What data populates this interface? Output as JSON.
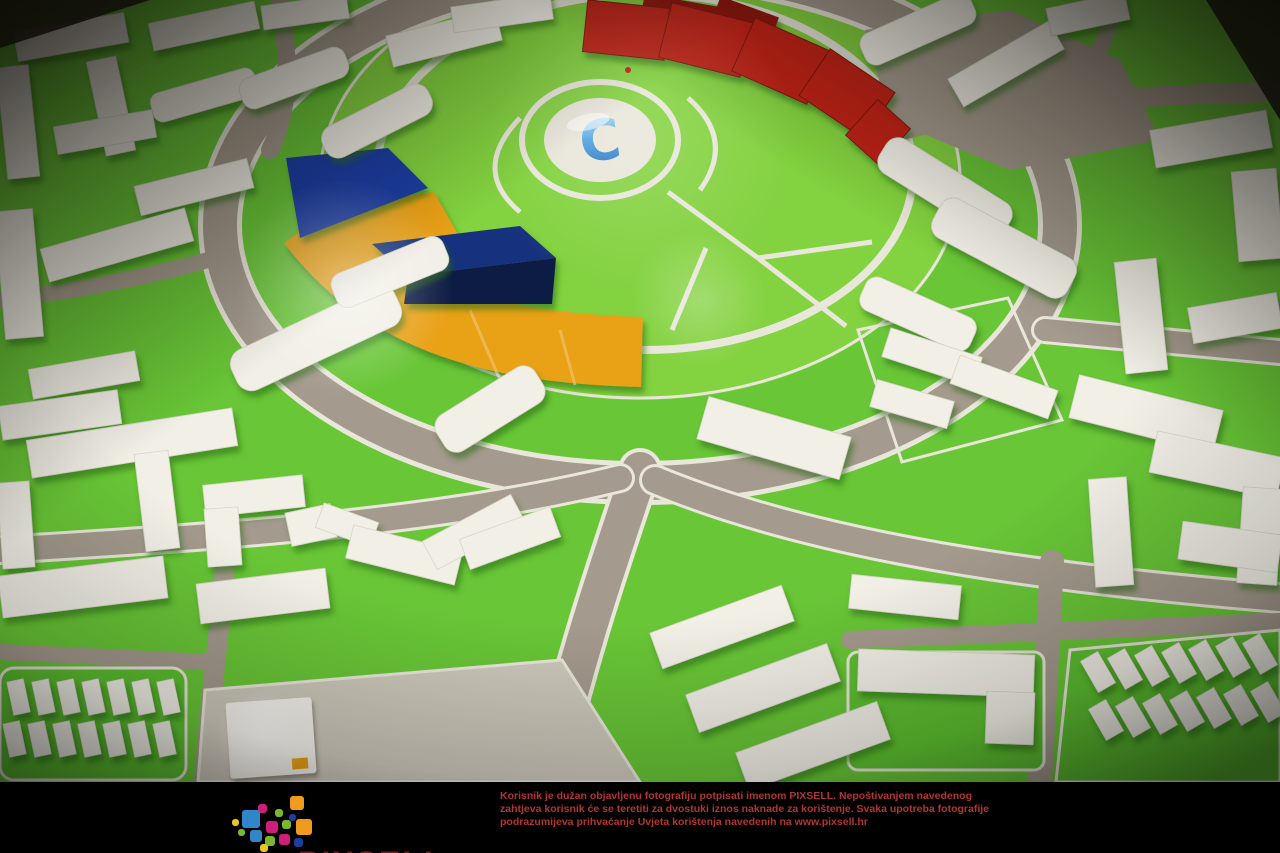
{
  "image": {
    "description": "Photograph of an architectural scale model of a circular city masterplan with white foam buildings on bright green ground, gray roads, a central round park with a glossy blue letter C plaza, a red arc building at top, a blue and orange arc building with a dark navy cube at left, and a black PIXSELL watermark bar at the bottom."
  },
  "scene": {
    "center_plaza_letter": "C"
  },
  "watermark": {
    "logo_text": "PIXSELL",
    "lines": [
      "Korisnik je dužan objavljenu fotografiju potpisati imenom PIXSELL. Nepoštivanjem navedenog",
      "zahtjeva korisnik će se teretiti za dvostuki iznos naknade za korištenje. Svaka upotreba fotografije",
      "podrazumijeva prihvaćanje Uvjeta korištenja navedenih na www.pixsell.hr"
    ]
  },
  "colors": {
    "ground_green": "#69c637",
    "park_green": "#83d23f",
    "lot_green": "#5dbf31",
    "road_gray": "#a49a8d",
    "sidewalk": "#e9e6da",
    "building_white": "#f1efe6",
    "arc_red": "#bf2318",
    "arc_red_dark": "#8e1710",
    "arc_orange": "#e9a117",
    "arc_blue": "#1e3da3",
    "cube_navy": "#0d1b45",
    "cube_top": "#16307e",
    "plaza_gray": "#cdc8bb",
    "c_blue": "#3b8fd4",
    "watermark_red": "#b23434",
    "bar_black": "#000000",
    "logo_blue": "#2f86c8",
    "logo_green": "#7cb62c",
    "logo_orange": "#ee9b1e",
    "logo_magenta": "#cf1d7c",
    "logo_yellow": "#e9c71f",
    "logo_navy": "#1d3f9c",
    "logo_word": "#7c1d1d"
  }
}
